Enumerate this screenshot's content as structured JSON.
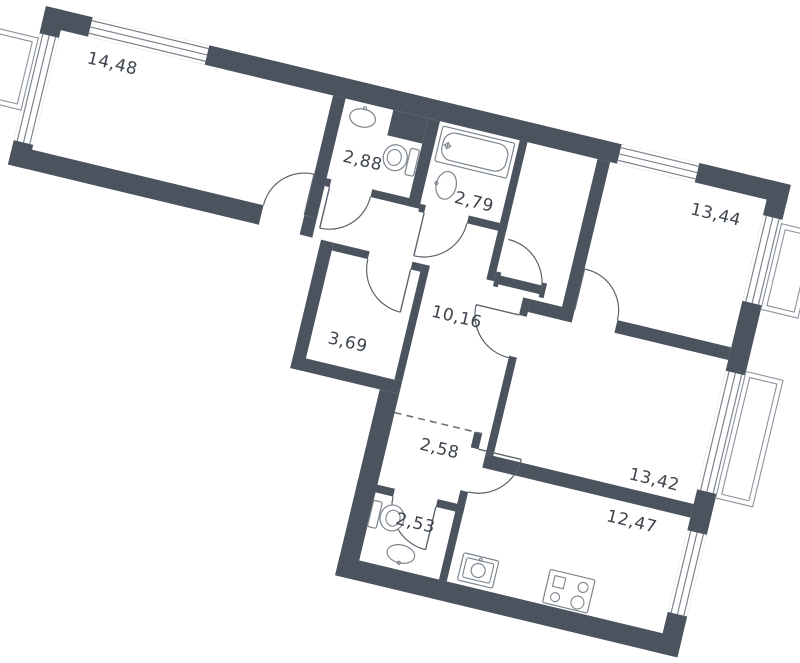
{
  "plan_title": "apartment-floor-plan",
  "rooms": [
    {
      "id": "living-room",
      "area": "14,48"
    },
    {
      "id": "bathroom-small",
      "area": "2,88"
    },
    {
      "id": "bathroom-large",
      "area": "2,79"
    },
    {
      "id": "bedroom-top",
      "area": "13,44"
    },
    {
      "id": "hallway",
      "area": "10,16"
    },
    {
      "id": "storage",
      "area": "3,69"
    },
    {
      "id": "corridor",
      "area": "2,58"
    },
    {
      "id": "bedroom-right",
      "area": "13,42"
    },
    {
      "id": "kitchen-living",
      "area": "12,47"
    },
    {
      "id": "wc",
      "area": "2,53"
    }
  ],
  "fixtures": [
    "sink",
    "toilet",
    "bathtub",
    "sink",
    "toilet",
    "sink",
    "kitchen-sink",
    "stove"
  ],
  "features": [
    "entrance-door",
    "balcony-left",
    "balcony-right-top",
    "balcony-right-middle",
    "windows",
    "door-swings",
    "dashed-opening",
    "ventilation-shaft"
  ],
  "colors": {
    "wall": "#4b535f",
    "thin_line": "#7d858e",
    "balcony_line": "#8b929b",
    "text": "#3d444c",
    "background": "#ffffff"
  }
}
